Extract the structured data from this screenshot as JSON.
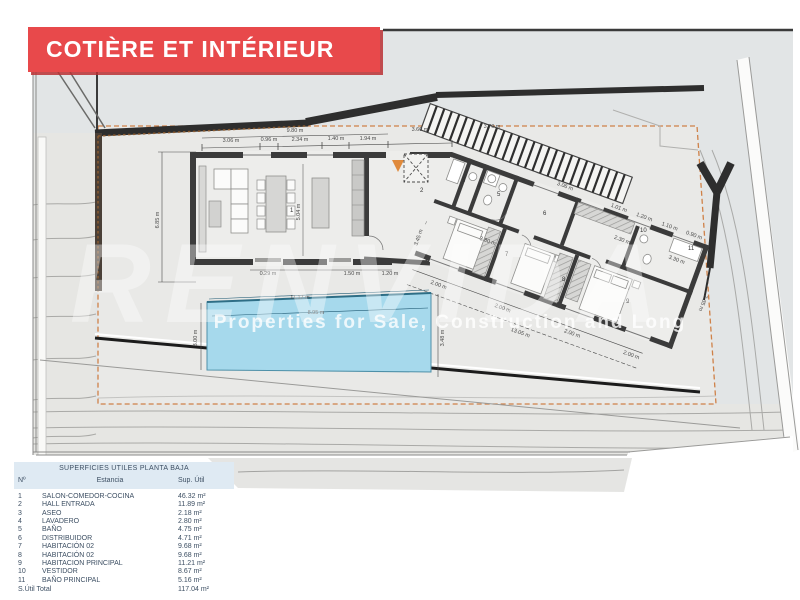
{
  "banner": {
    "title": "COTIÈRE ET INTÉRIEUR",
    "bg_color": "#e8494b"
  },
  "watermark": {
    "brand": "RENVIDA",
    "tagline": "Properties for Sale, Construction and Long"
  },
  "plan": {
    "pool_color": "#a6d9ec",
    "boundary_color": "#cf8148",
    "dims": {
      "top": "9.80 m",
      "s1": "3.06 m",
      "s2": "0.96 m",
      "s3": "2.34 m",
      "s4": "1.40 m",
      "s5": "1.94 m",
      "e1": "3.60 m",
      "e2": "3.70 m",
      "w1": "3.06 m",
      "w2": "1.01 m",
      "w3": "1.20 m",
      "w4": "1.10 m",
      "w5": "0.90 m",
      "left": "6.85 m",
      "inner": "5.04 m",
      "sill1": "0.29 m",
      "sill2": "1.50 m",
      "sill3": "1.20 m",
      "hall": "3.45 m",
      "diag": "3.80 m",
      "c230": "2.30 m",
      "c330": "3.30 m",
      "b1": "2.00 m",
      "b2": "2.00 m",
      "b3": "2.00 m",
      "b4": "2.00 m",
      "btot": "13.05 m",
      "wingr": "7.35 m",
      "pool_top": "11.17 m",
      "pool_in": "8.95 m",
      "pool_l": "3.00 m",
      "pool_r": "3.48 m"
    },
    "rooms": {
      "r1": "1",
      "r2": "2",
      "r3": "3",
      "r4": "4",
      "r5": "5",
      "r6": "6",
      "r7": "7",
      "r8": "8",
      "r9": "9",
      "r10": "10",
      "r11": "11"
    }
  },
  "table": {
    "title": "SUPERFICIES UTILES PLANTA BAJA",
    "columns": {
      "num": "Nº",
      "name": "Estancia",
      "area": "Sup. Útil"
    },
    "rows": [
      {
        "n": "1",
        "name": "SALON-COMEDOR-COCINA",
        "area": "46.32 m²"
      },
      {
        "n": "2",
        "name": "HALL ENTRADA",
        "area": "11.89 m²"
      },
      {
        "n": "3",
        "name": "ASEO",
        "area": "2.18 m²"
      },
      {
        "n": "4",
        "name": "LAVADERO",
        "area": "2.80 m²"
      },
      {
        "n": "5",
        "name": "BAÑO",
        "area": "4.75 m²"
      },
      {
        "n": "6",
        "name": "DISTRIBUIDOR",
        "area": "4.71 m²"
      },
      {
        "n": "7",
        "name": "HABITACIÓN 02",
        "area": "9.68 m²"
      },
      {
        "n": "8",
        "name": "HABITACIÓN 02",
        "area": "9.68 m²"
      },
      {
        "n": "9",
        "name": "HABITACION PRINCIPAL",
        "area": "11.21 m²"
      },
      {
        "n": "10",
        "name": "VESTIDOR",
        "area": "8.67 m²"
      },
      {
        "n": "11",
        "name": "BAÑO PRINCIPAL",
        "area": "5.16 m²"
      }
    ],
    "total_label": "S.Útil Total",
    "total_value": "117.04 m²"
  }
}
